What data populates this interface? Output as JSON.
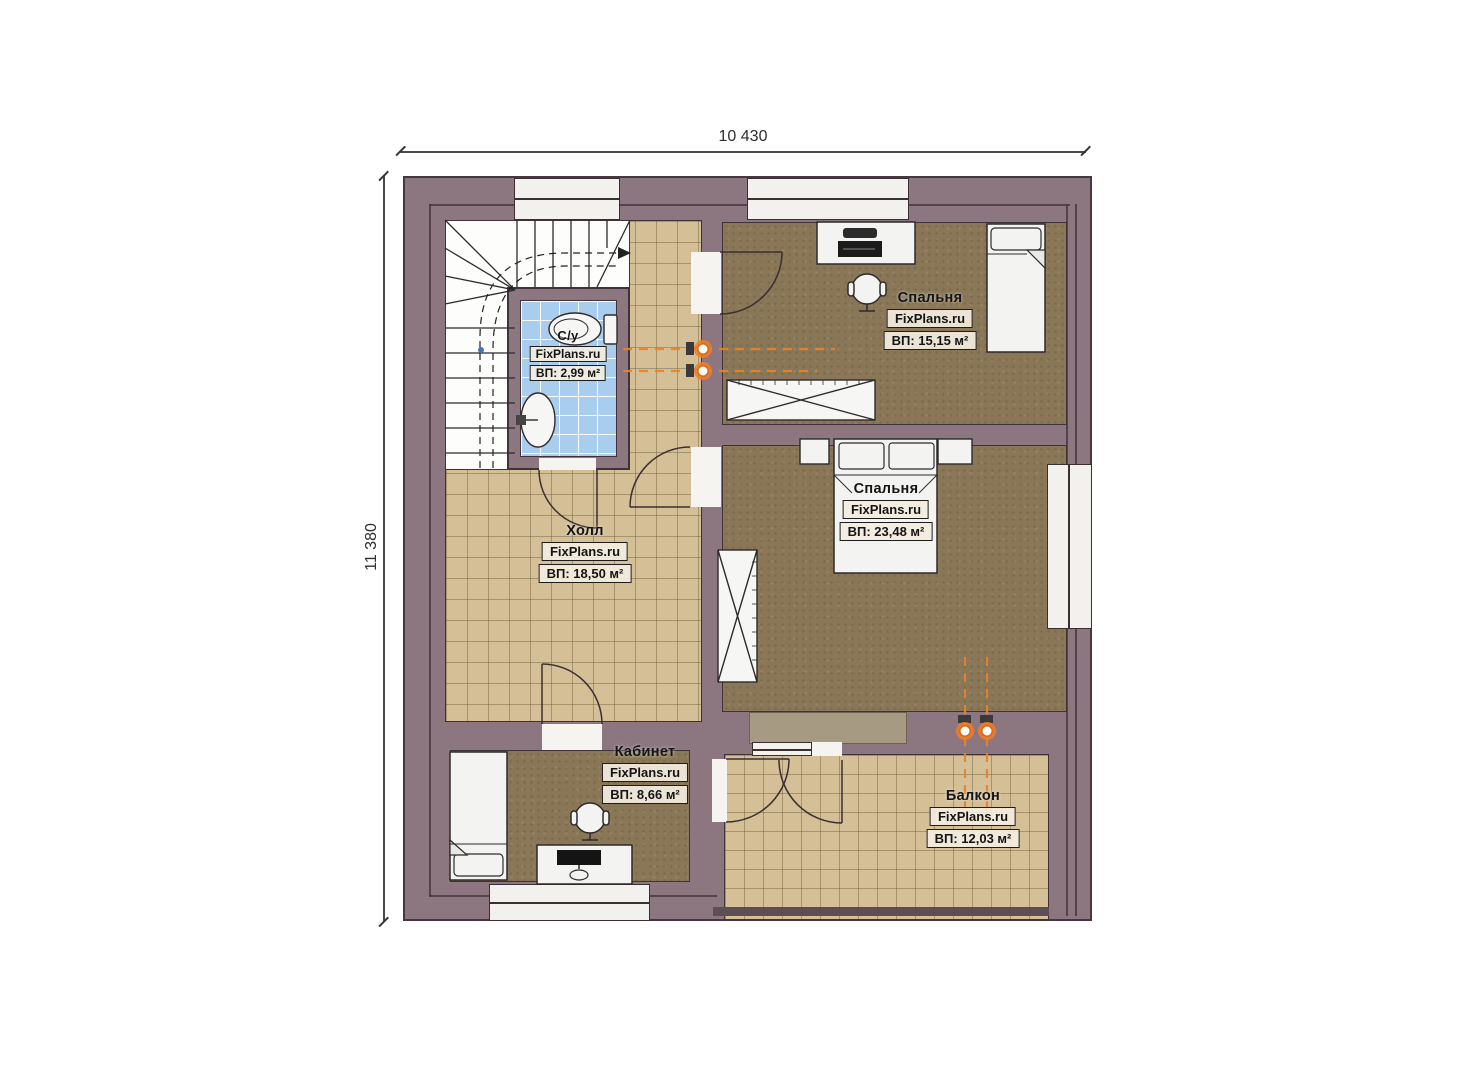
{
  "plan": {
    "title": "second-floor-plan",
    "dimension_top": "10 430",
    "dimension_left": "11 380"
  },
  "rooms": [
    {
      "key": "bedroom-top",
      "name": "Спальня",
      "brand": "FixPlans.ru",
      "area": "ВП: 15,15 м²"
    },
    {
      "key": "bedroom-master",
      "name": "Спальня",
      "brand": "FixPlans.ru",
      "area": "ВП: 23,48 м²"
    },
    {
      "key": "hall",
      "name": "Холл",
      "brand": "FixPlans.ru",
      "area": "ВП: 18,50 м²"
    },
    {
      "key": "bathroom",
      "name": "С/у",
      "brand": "FixPlans.ru",
      "area": "ВП: 2,99 м²"
    },
    {
      "key": "office",
      "name": "Кабинет",
      "brand": "FixPlans.ru",
      "area": "ВП: 8,66 м²"
    },
    {
      "key": "balcony",
      "name": "Балкон",
      "brand": "FixPlans.ru",
      "area": "ВП: 12,03 м²"
    }
  ],
  "icons": {
    "staircase": "stairs-with-walk-line",
    "radiator": "orange-heating-riser",
    "wardrobe": "crossed-box",
    "toilet": "toilet-top-view",
    "sink": "sink-top-view"
  },
  "colors": {
    "wall": "#8c7680",
    "wall_line": "#463741",
    "floor_wood": "#897757",
    "tile_tan": "#d4bf96",
    "tile_blue": "#a9cdee",
    "radiator_orange": "#f0801f",
    "window_fill": "#f2f1ee"
  }
}
